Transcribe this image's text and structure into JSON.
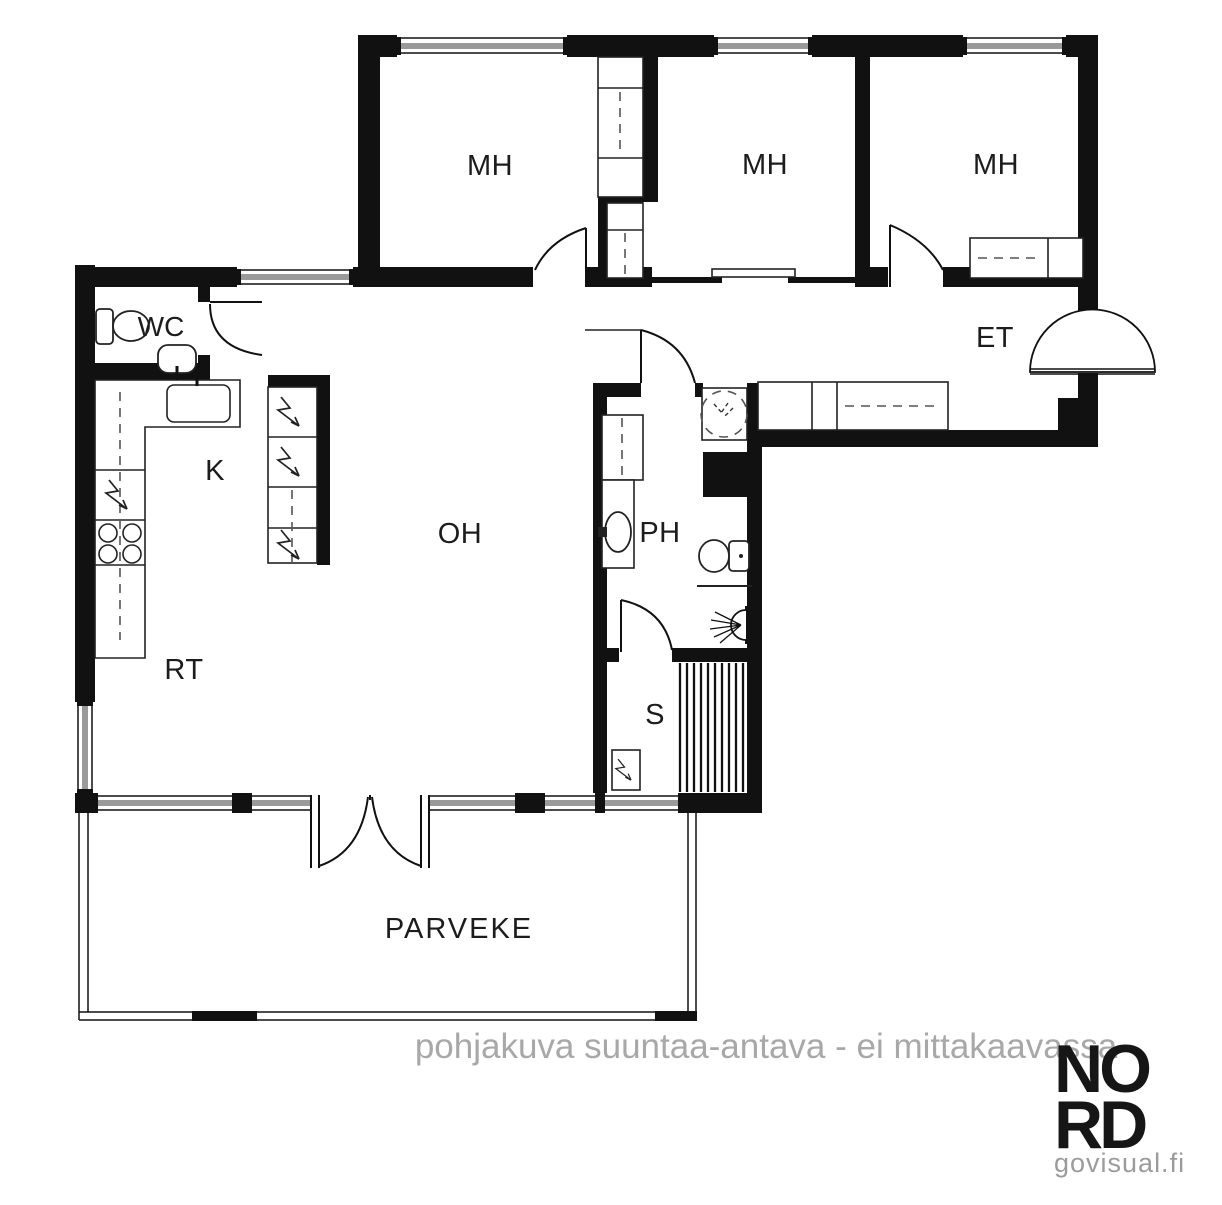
{
  "plan": {
    "title_type": "floor-plan",
    "rooms": [
      {
        "id": "mh1",
        "label": "MH"
      },
      {
        "id": "mh2",
        "label": "MH"
      },
      {
        "id": "mh3",
        "label": "MH"
      },
      {
        "id": "wc",
        "label": "WC"
      },
      {
        "id": "et",
        "label": "ET"
      },
      {
        "id": "k",
        "label": "K"
      },
      {
        "id": "oh",
        "label": "OH"
      },
      {
        "id": "ph",
        "label": "PH"
      },
      {
        "id": "rt",
        "label": "RT"
      },
      {
        "id": "s",
        "label": "S"
      },
      {
        "id": "parveke",
        "label": "PARVEKE"
      }
    ],
    "colors": {
      "wall": "#111111",
      "line": "#222222",
      "glass_gray": "#9a9a9a",
      "note_gray": "#a8a8a8",
      "background": "#ffffff"
    }
  },
  "footer": {
    "disclaimer": "pohjakuva suuntaa-antava - ei mittakaavassa"
  },
  "brand": {
    "logo_line1": "NO",
    "logo_line2": "RD",
    "site": "govisual.fi"
  }
}
